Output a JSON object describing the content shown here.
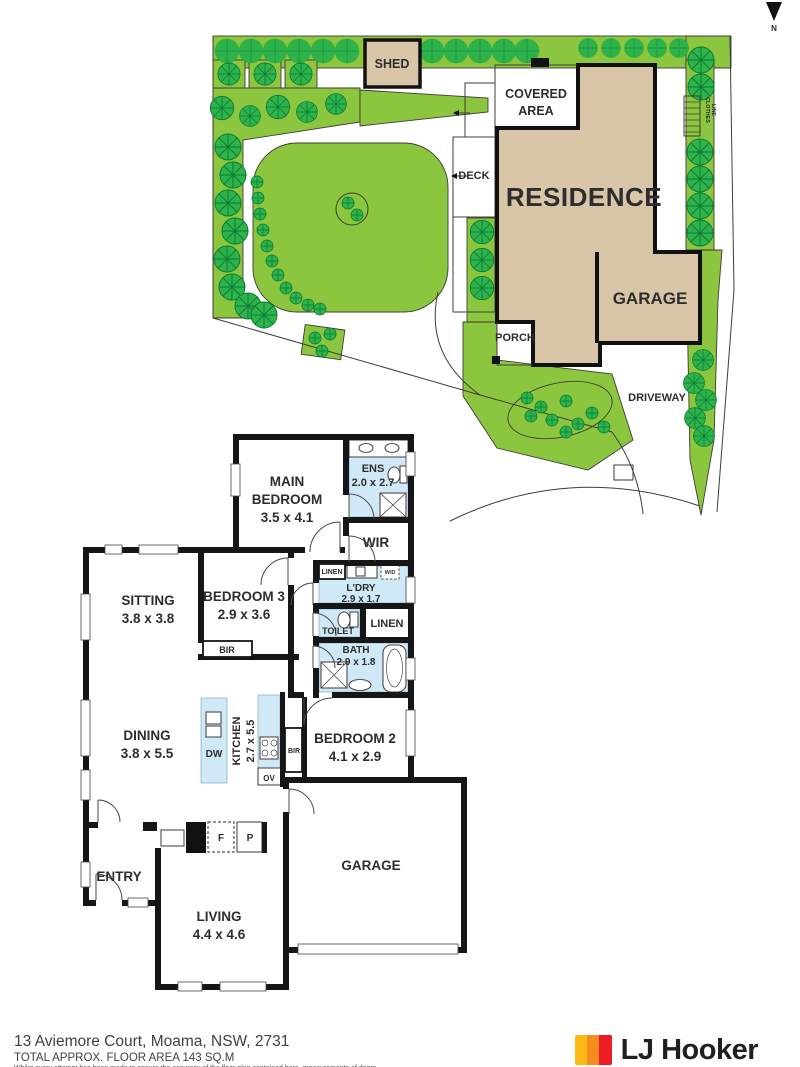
{
  "north": {
    "label": "N"
  },
  "site_plan": {
    "shed": "SHED",
    "covered_area_line1": "COVERED",
    "covered_area_line2": "AREA",
    "deck": "DECK",
    "residence": "RESIDENCE",
    "garage": "GARAGE",
    "porch": "PORCH",
    "driveway": "DRIVEWAY",
    "clothes_line_line1": "CLOTHES",
    "clothes_line_line2": "LINE"
  },
  "floor_plan": {
    "main_bedroom": {
      "line1": "MAIN",
      "line2": "BEDROOM",
      "dims": "3.5 x 4.1"
    },
    "ens": {
      "label": "ENS",
      "dims": "2.0 x 2.7"
    },
    "wir": {
      "label": "WIR"
    },
    "sitting": {
      "label": "SITTING",
      "dims": "3.8 x 3.8"
    },
    "bedroom3": {
      "label": "BEDROOM 3",
      "dims": "2.9 x 3.6"
    },
    "bir_bedroom3": {
      "label": "BIR"
    },
    "linen_hall": {
      "label": "LINEN"
    },
    "laundry": {
      "label": "L'DRY",
      "dims": "2.9 x 1.7"
    },
    "washer_dryer": {
      "label": "W/D"
    },
    "toilet": {
      "label": "TOILET"
    },
    "linen": {
      "label": "LINEN"
    },
    "bath": {
      "label": "BATH",
      "dims": "2.9 x 1.8"
    },
    "dining": {
      "label": "DINING",
      "dims": "3.8 x 5.5"
    },
    "kitchen": {
      "label": "KITCHEN",
      "dims": "2.7 x 5.5"
    },
    "dishwasher": {
      "label": "DW"
    },
    "oven": {
      "label": "OV"
    },
    "bir_bedroom2": {
      "label": "BIR"
    },
    "bedroom2": {
      "label": "BEDROOM 2",
      "dims": "4.1 x 2.9"
    },
    "entry": {
      "label": "ENTRY"
    },
    "fridge": {
      "label": "F"
    },
    "pantry": {
      "label": "P"
    },
    "living": {
      "label": "LIVING",
      "dims": "4.4 x 4.6"
    },
    "garage": {
      "label": "GARAGE"
    }
  },
  "footer": {
    "address": "13 Aviemore Court, Moama, NSW, 2731",
    "floor_area": "TOTAL APPROX. FLOOR AREA 143 SQ.M",
    "disclaimer": "Whilst every attempt has been made to ensure the accuracy of the floor plan contained here, measurements of doors",
    "brand": "LJ Hooker"
  },
  "colors": {
    "lawn_green": "#8cc63e",
    "tree_green": "#2eb34b",
    "building_tan": "#d9c5a7",
    "wet_area_blue": "#cfe9f6",
    "wall_black": "#161616",
    "logo_yellow": "#fdb913",
    "logo_orange": "#f68b1f",
    "logo_red": "#ed1c24"
  }
}
